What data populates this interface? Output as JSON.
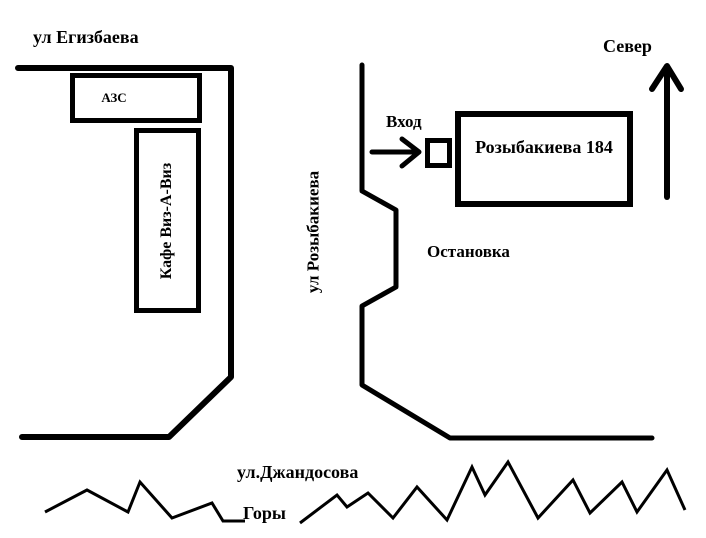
{
  "map": {
    "colors": {
      "ink": "#000000",
      "background": "#ffffff"
    },
    "labels": {
      "egizbaeva_street": "ул Егизбаева",
      "north": "Север",
      "gas_station": "АЗС",
      "cafe": "Кафе Виз-А-Виз",
      "rozybakieva_street": "ул Розыбакиева",
      "entrance": "Вход",
      "building": "Розыбакиева 184",
      "bus_stop": "Остановка",
      "dzhandosova_street": "ул.Джандосова",
      "mountains": "Горы"
    }
  }
}
